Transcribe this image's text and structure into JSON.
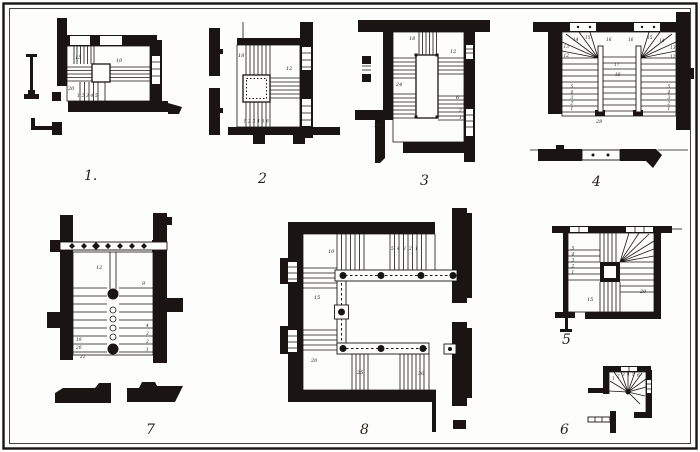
{
  "plate": {
    "ink_color": "#1a1512",
    "paper_color": "#fdfdfb"
  },
  "figures": {
    "f1": {
      "number": "1.",
      "labels": {
        "n15": "15",
        "n10": "10",
        "n20": "20"
      },
      "steps": [
        "1",
        "2",
        "3",
        "4",
        "5"
      ]
    },
    "f2": {
      "number": "2",
      "labels": {
        "n18": "18",
        "n12": "12"
      },
      "steps": [
        "1",
        "2",
        "3",
        "4",
        "5",
        "6"
      ]
    },
    "f3": {
      "number": "3",
      "labels": {
        "n18": "18",
        "n12": "12",
        "n24": "24",
        "n6": "6",
        "n2": "2",
        "n1": "1",
        "n30": "30"
      }
    },
    "f4": {
      "number": "4",
      "labels": {
        "w12l": "12",
        "w13l": "13",
        "w14l": "14",
        "w15l": "15",
        "w16l": "16",
        "w16r": "16",
        "w15r": "15",
        "w14r": "14",
        "w13r": "13",
        "w12r": "12",
        "c17": "17",
        "c18": "18",
        "n28": "28"
      },
      "steps_left": [
        "5",
        "4",
        "3",
        "2",
        "1"
      ],
      "steps_right": [
        "5",
        "4",
        "3",
        "2",
        "1"
      ]
    },
    "f5": {
      "number": "5",
      "labels": {
        "n15": "15",
        "n20": "20"
      },
      "steps": [
        "5",
        "4",
        "3",
        "2",
        "1"
      ]
    },
    "f6": {
      "number": "6",
      "steps": [
        "1",
        "2",
        "3",
        "4",
        "5",
        "6"
      ]
    },
    "f7": {
      "number": "7",
      "labels": {
        "n12": "12",
        "n9": "9",
        "n19": "19",
        "n20": "20",
        "n21": "21"
      },
      "steps": [
        "4",
        "3",
        "2",
        "1"
      ]
    },
    "f8": {
      "number": "8",
      "labels": {
        "n10": "10",
        "n15": "15",
        "n20": "20",
        "n25": "25",
        "n30": "30"
      },
      "steps": [
        "5",
        "4",
        "3",
        "2",
        "1"
      ]
    }
  }
}
